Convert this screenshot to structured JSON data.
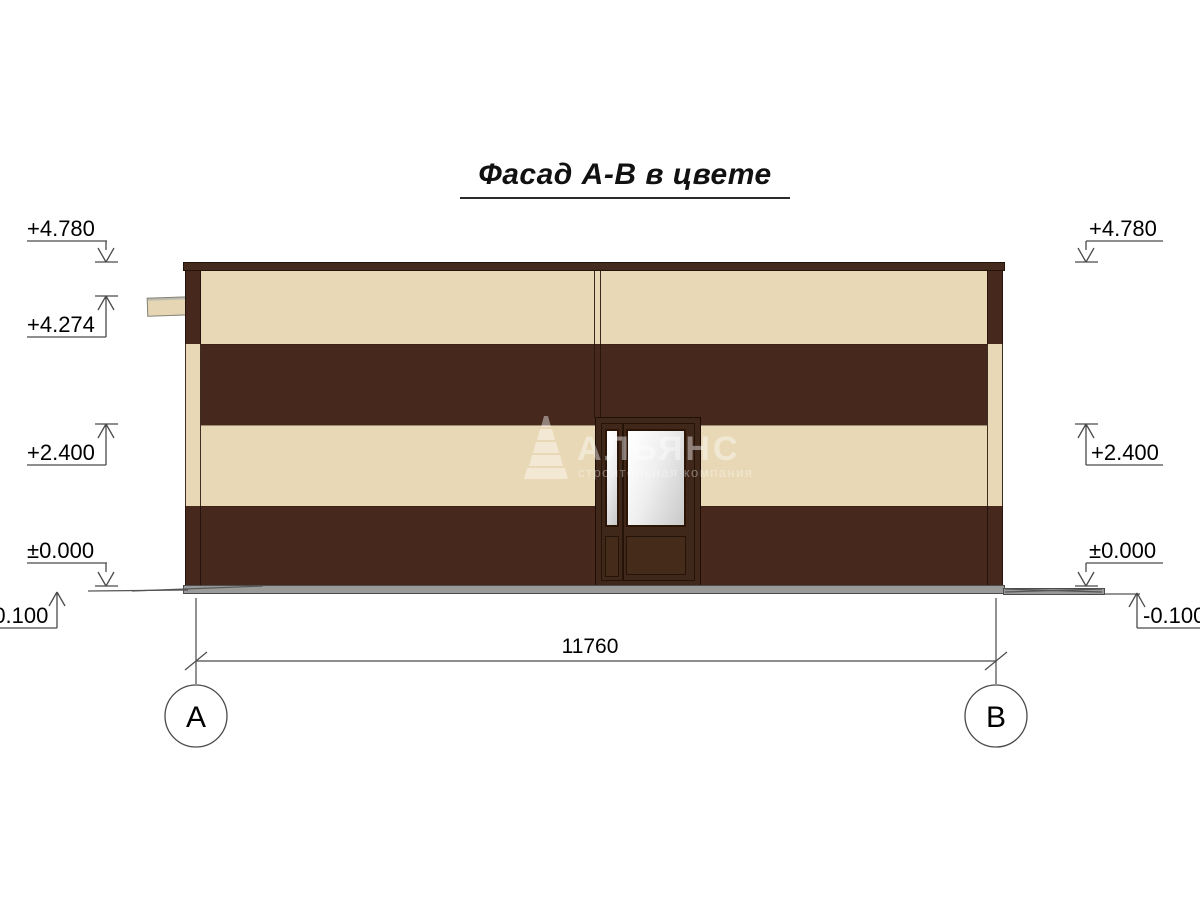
{
  "title": "Фасад А-В в цвете",
  "watermark": {
    "name": "АЛЬЯНС",
    "subtitle": "строительная компания",
    "logo": "stepped-pyramid-icon"
  },
  "elevation_marks": {
    "left": {
      "parapet": "+4.780",
      "scupper": "+4.274",
      "door_head": "+2.400",
      "zero": "±0.000",
      "ground": "-0.100"
    },
    "right": {
      "parapet": "+4.780",
      "door_head": "+2.400",
      "zero": "±0.000",
      "ground": "-0.100"
    }
  },
  "dimension": {
    "overall_width": "11760"
  },
  "axes": {
    "left": "А",
    "right": "В"
  },
  "colors": {
    "facade_cream": "#e8d8b5",
    "facade_brown": "#46291c",
    "door_frame_brown": "#3f2719",
    "plinth_gray": "#9a9a9a",
    "glass_light": "#efefef",
    "line": "#4a4a4a"
  }
}
